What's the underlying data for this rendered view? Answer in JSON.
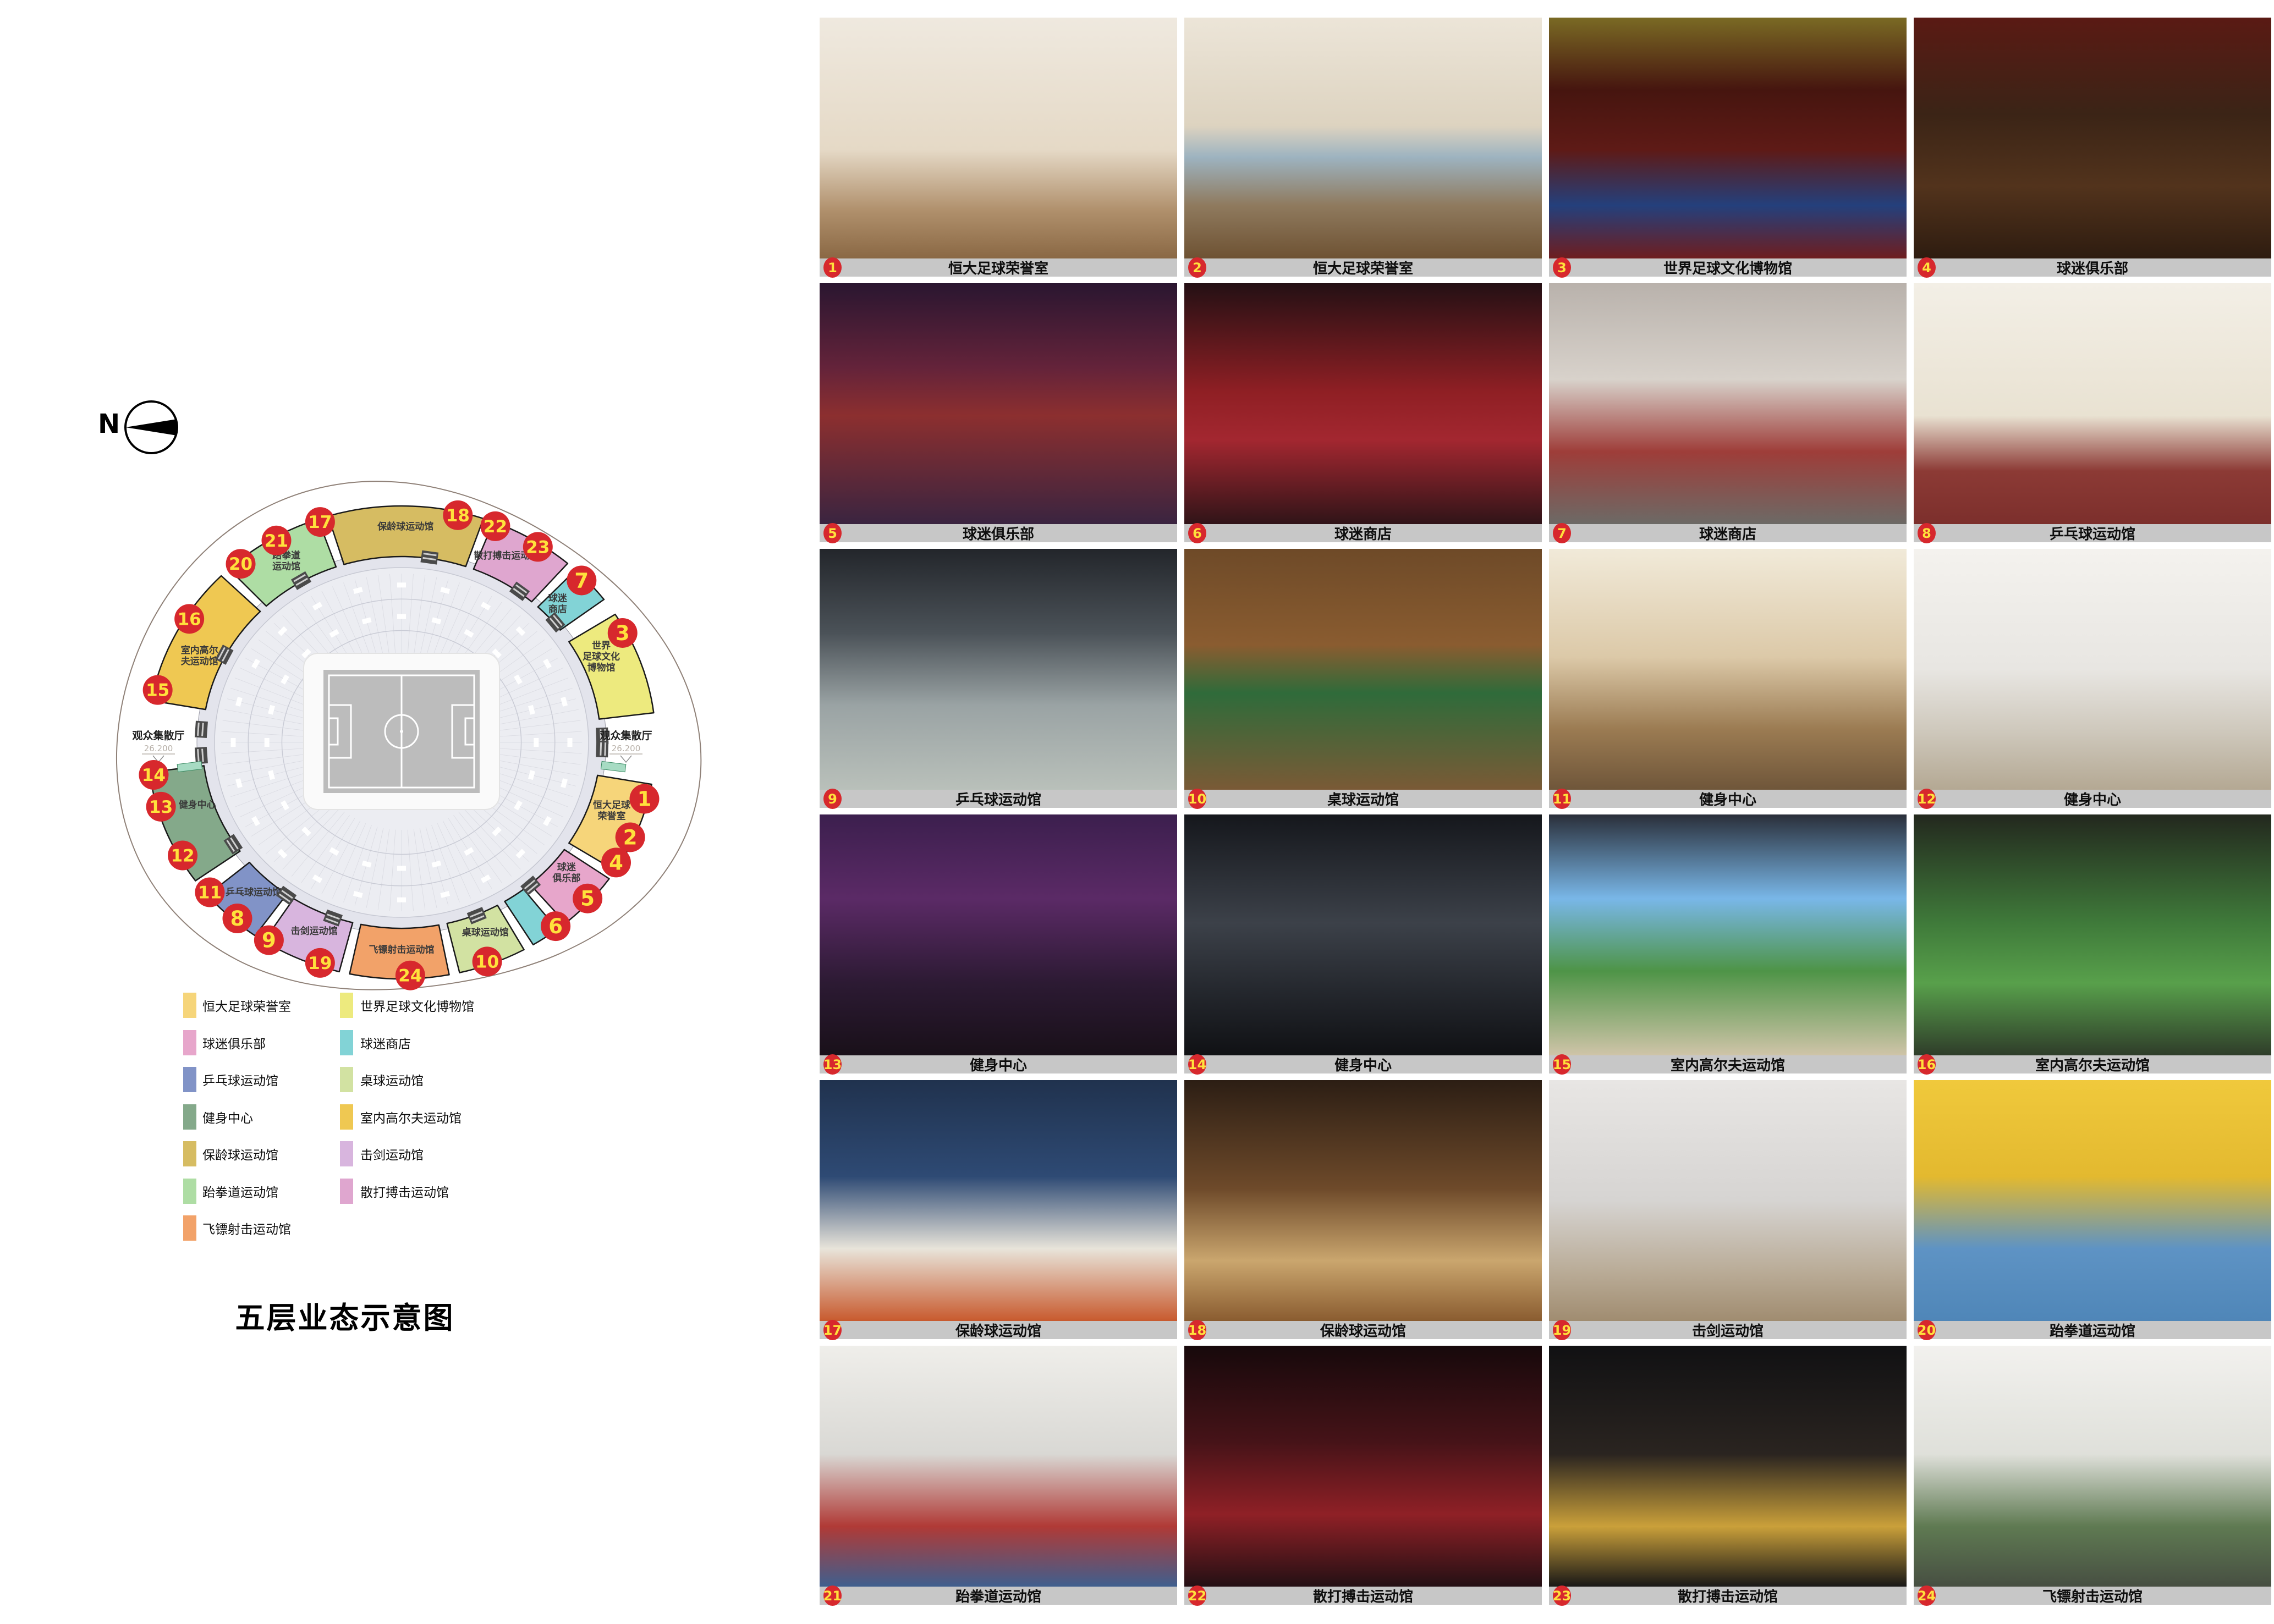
{
  "page": {
    "background": "#ffffff"
  },
  "north": {
    "label": "N"
  },
  "plan": {
    "title": "五层业态示意图",
    "halls": [
      {
        "label": "观众集散厅",
        "elevation": "26.200",
        "side": "right"
      },
      {
        "label": "观众集散厅",
        "elevation": "26.200",
        "side": "left"
      }
    ],
    "zones": [
      {
        "id": "taekwondo",
        "label": "跆拳道运动馆",
        "lines": [
          "跆拳道",
          "运动馆"
        ],
        "color": "#AEDDA4",
        "start": -44,
        "end": -18,
        "labelAngle": -31,
        "labelR": 0.88
      },
      {
        "id": "bowling",
        "label": "保龄球运动馆",
        "lines": [
          "保龄球运动馆"
        ],
        "color": "#D6BC62",
        "start": -18,
        "end": 20,
        "labelAngle": 1,
        "labelR": 0.9
      },
      {
        "id": "sanda",
        "label": "散打搏击运动馆",
        "lines": [
          "散打搏击运动馆"
        ],
        "color": "#DFA6CF",
        "start": 20,
        "end": 42,
        "labelAngle": 28,
        "labelR": 0.88
      },
      {
        "id": "fanshop-north",
        "label": "球迷商店",
        "lines": [
          "球迷",
          "商店"
        ],
        "color": "#82D3D6",
        "start": 42,
        "end": 54,
        "labelAngle": 47,
        "labelR": 0.84
      },
      {
        "id": "museum",
        "label": "世界足球文化博物馆",
        "lines": [
          "世界",
          "足球文化",
          "博物馆"
        ],
        "color": "#EDEA7E",
        "start": 56,
        "end": 84,
        "labelAngle": 66,
        "labelR": 0.86
      },
      {
        "id": "honor-room",
        "label": "恒大足球荣誉室",
        "lines": [
          "恒大足球",
          "荣誉室"
        ],
        "color": "#F6D57A",
        "start": 99,
        "end": 124,
        "labelAngle": 110,
        "labelR": 0.88
      },
      {
        "id": "fan-club",
        "label": "球迷俱乐部",
        "lines": [
          "球迷",
          "俱乐部"
        ],
        "color": "#E7A6CB",
        "start": 124,
        "end": 141,
        "labelAngle": 131,
        "labelR": 0.86
      },
      {
        "id": "fanshop-south",
        "label": "球迷商店",
        "lines": [],
        "color": "#82D3D6",
        "start": 141,
        "end": 150,
        "labelAngle": 145,
        "labelR": 0.86
      },
      {
        "id": "billiards",
        "label": "桌球运动馆",
        "lines": [
          "桌球运动馆"
        ],
        "color": "#D2E2A2",
        "start": 150,
        "end": 168,
        "labelAngle": 158,
        "labelR": 0.88
      },
      {
        "id": "darts",
        "label": "飞镖射击运动馆",
        "lines": [
          "飞镖射击运动馆"
        ],
        "color": "#F2A269",
        "start": 168,
        "end": 193,
        "labelAngle": 180,
        "labelR": 0.89
      },
      {
        "id": "fencing",
        "label": "击剑运动馆",
        "lines": [
          "击剑运动馆"
        ],
        "color": "#D8B5DE",
        "start": 193,
        "end": 214,
        "labelAngle": 203,
        "labelR": 0.88
      },
      {
        "id": "table-tennis",
        "label": "乒乓球运动馆",
        "lines": [
          "乒乓球运动馆"
        ],
        "color": "#8193C7",
        "start": 214,
        "end": 231,
        "labelAngle": 222,
        "labelR": 0.87
      },
      {
        "id": "fitness",
        "label": "健身中心",
        "lines": [
          "健身中心"
        ],
        "color": "#84A98A",
        "start": 233,
        "end": 264,
        "labelAngle": 251,
        "labelR": 0.85
      },
      {
        "id": "golf",
        "label": "室内高尔夫运动馆",
        "lines": [
          "室内高尔",
          "夫运动馆"
        ],
        "color": "#EFC852",
        "start": 279,
        "end": 316,
        "labelAngle": 294,
        "labelR": 0.87
      }
    ],
    "badges": [
      {
        "n": 1,
        "angle": 104
      },
      {
        "n": 2,
        "angle": 114
      },
      {
        "n": 3,
        "angle": 62
      },
      {
        "n": 4,
        "angle": 121
      },
      {
        "n": 5,
        "angle": 132
      },
      {
        "n": 6,
        "angle": 142
      },
      {
        "n": 7,
        "angle": 46
      },
      {
        "n": 8,
        "angle": 221
      },
      {
        "n": 9,
        "angle": 212
      },
      {
        "n": 10,
        "angle": 160
      },
      {
        "n": 11,
        "angle": 230
      },
      {
        "n": 12,
        "angle": 241
      },
      {
        "n": 13,
        "angle": 254
      },
      {
        "n": 14,
        "angle": 262
      },
      {
        "n": 15,
        "angle": 283
      },
      {
        "n": 16,
        "angle": 302
      },
      {
        "n": 17,
        "angle": -19
      },
      {
        "n": 18,
        "angle": 13
      },
      {
        "n": 19,
        "angle": 199
      },
      {
        "n": 20,
        "angle": -40
      },
      {
        "n": 21,
        "angle": -30
      },
      {
        "n": 22,
        "angle": 22
      },
      {
        "n": 23,
        "angle": 33
      },
      {
        "n": 24,
        "angle": 178
      }
    ],
    "colors": {
      "badge_bg": "#D7282D",
      "badge_text": "#FFE13C",
      "zone_outline": "#1A1A1A",
      "petal_stroke": "#8F8178",
      "bowl_fill": "#ECEDF2",
      "walkway_fill": "#E3E4EC",
      "pitch_field": "#BCBCBC",
      "pitch_pad": "#FAFAFA",
      "pitch_line": "#FFFFFF",
      "hall_text": "#1F1F1F",
      "elevation_text": "#B7B0A8",
      "zone_label_text": "#3A3A3A",
      "stair_fill": "#4A4A4A",
      "sliver_fill": "#A7DBC3"
    }
  },
  "legend": {
    "left": [
      {
        "label": "恒大足球荣誉室",
        "color": "#F6D57A"
      },
      {
        "label": "球迷俱乐部",
        "color": "#E7A6CB"
      },
      {
        "label": "乒乓球运动馆",
        "color": "#8193C7"
      },
      {
        "label": "健身中心",
        "color": "#84A98A"
      },
      {
        "label": "保龄球运动馆",
        "color": "#D6BC62"
      },
      {
        "label": "跆拳道运动馆",
        "color": "#AEDDA4"
      },
      {
        "label": "飞镖射击运动馆",
        "color": "#F2A269"
      }
    ],
    "right": [
      {
        "label": "世界足球文化博物馆",
        "color": "#EDEA7E"
      },
      {
        "label": "球迷商店",
        "color": "#82D3D6"
      },
      {
        "label": "桌球运动馆",
        "color": "#D2E2A2"
      },
      {
        "label": "室内高尔夫运动馆",
        "color": "#EFC852"
      },
      {
        "label": "击剑运动馆",
        "color": "#D8B5DE"
      },
      {
        "label": "散打搏击运动馆",
        "color": "#DFA6CF"
      }
    ]
  },
  "photos": {
    "caption_bar_color": "#C7C7C7",
    "items": [
      {
        "n": 1,
        "caption": "恒大足球荣誉室",
        "bg": "linear-gradient(180deg,#efe9df 0%,#e5d9c6 55%,#b0906c 80%,#8a6844 100%)"
      },
      {
        "n": 2,
        "caption": "恒大足球荣誉室",
        "bg": "linear-gradient(180deg,#ece5d8 0%,#ddd3c0 45%,#9db3c0 58%,#8f7a5e 78%,#6e5233 100%)"
      },
      {
        "n": 3,
        "caption": "世界足球文化博物馆",
        "bg": "linear-gradient(180deg,#7a6a24 0%,#46150f 30%,#5e1a16 55%,#24407c 78%,#6e1d1f 100%)"
      },
      {
        "n": 4,
        "caption": "球迷俱乐部",
        "bg": "linear-gradient(180deg,#5a1a14 0%,#3b2416 40%,#52331c 70%,#2e1c10 100%)"
      },
      {
        "n": 5,
        "caption": "球迷俱乐部",
        "bg": "linear-gradient(180deg,#2a1630 0%,#64233a 35%,#8c2f2f 55%,#3a2440 100%)"
      },
      {
        "n": 6,
        "caption": "球迷商店",
        "bg": "linear-gradient(180deg,#241014 0%,#8f1f24 45%,#a32730 65%,#301418 100%)"
      },
      {
        "n": 7,
        "caption": "球迷商店",
        "bg": "linear-gradient(180deg,#b9b2ac 0%,#d8d2cb 40%,#9e3d39 70%,#6c6a66 100%)"
      },
      {
        "n": 8,
        "caption": "乒乓球运动馆",
        "bg": "linear-gradient(180deg,#f3efe6 0%,#e9e2d2 55%,#8c3a35 78%,#7c2f2c 100%)"
      },
      {
        "n": 9,
        "caption": "乒乓球运动馆",
        "bg": "linear-gradient(180deg,#23262b 0%,#4b5258 35%,#9aa3a4 65%,#b9c0ba 100%)"
      },
      {
        "n": 10,
        "caption": "桌球运动馆",
        "bg": "linear-gradient(180deg,#6e4a28 0%,#8a5c30 40%,#2f6b3a 60%,#7a5a36 100%)"
      },
      {
        "n": 11,
        "caption": "健身中心",
        "bg": "linear-gradient(180deg,#f1ead9 0%,#dcc9a8 45%,#9b7b52 75%,#6f563a 100%)"
      },
      {
        "n": 12,
        "caption": "健身中心",
        "bg": "linear-gradient(180deg,#f4f2ee 0%,#e8e6e2 50%,#cfc9bd 75%,#b4a893 100%)"
      },
      {
        "n": 13,
        "caption": "健身中心",
        "bg": "linear-gradient(180deg,#3c1f4e 0%,#5b2a66 35%,#2c1a33 70%,#191019 100%)"
      },
      {
        "n": 14,
        "caption": "健身中心",
        "bg": "linear-gradient(180deg,#15171c 0%,#3c4149 45%,#23262c 75%,#101114 100%)"
      },
      {
        "n": 15,
        "caption": "室内高尔夫运动馆",
        "bg": "linear-gradient(180deg,#2a2f3a 0%,#79b7e8 35%,#4e9447 65%,#cfc4a8 100%)"
      },
      {
        "n": 16,
        "caption": "室内高尔夫运动馆",
        "bg": "linear-gradient(180deg,#23281e 0%,#3f7a3a 45%,#58a04b 70%,#2f3d2a 100%)"
      },
      {
        "n": 17,
        "caption": "保龄球运动馆",
        "bg": "linear-gradient(180deg,#20324e 0%,#2e4a74 40%,#e8e4da 70%,#c85a2e 100%)"
      },
      {
        "n": 18,
        "caption": "保龄球运动馆",
        "bg": "linear-gradient(180deg,#2c1e14 0%,#6e4a2a 45%,#caa66e 75%,#8a5c30 100%)"
      },
      {
        "n": 19,
        "caption": "击剑运动馆",
        "bg": "linear-gradient(180deg,#e8e6e4 0%,#d6d4d2 50%,#b9ab96 80%,#a08c70 100%)"
      },
      {
        "n": 20,
        "caption": "跆拳道运动馆",
        "bg": "linear-gradient(180deg,#f0c93c 0%,#e3b92f 40%,#5e93c4 70%,#4f86b8 100%)"
      },
      {
        "n": 21,
        "caption": "跆拳道运动馆",
        "bg": "linear-gradient(180deg,#efeeea 0%,#d9d8d4 45%,#b03a36 75%,#3f5f8e 100%)"
      },
      {
        "n": 22,
        "caption": "散打搏击运动馆",
        "bg": "linear-gradient(180deg,#17090b 0%,#461318 40%,#8f2026 70%,#241014 100%)"
      },
      {
        "n": 23,
        "caption": "散打搏击运动馆",
        "bg": "linear-gradient(180deg,#111113 0%,#2a2420 45%,#caa03a 75%,#191817 100%)"
      },
      {
        "n": 24,
        "caption": "飞镖射击运动馆",
        "bg": "linear-gradient(180deg,#f2f1ee 0%,#dfe0da 45%,#5f7a52 75%,#474f42 100%)"
      }
    ]
  }
}
